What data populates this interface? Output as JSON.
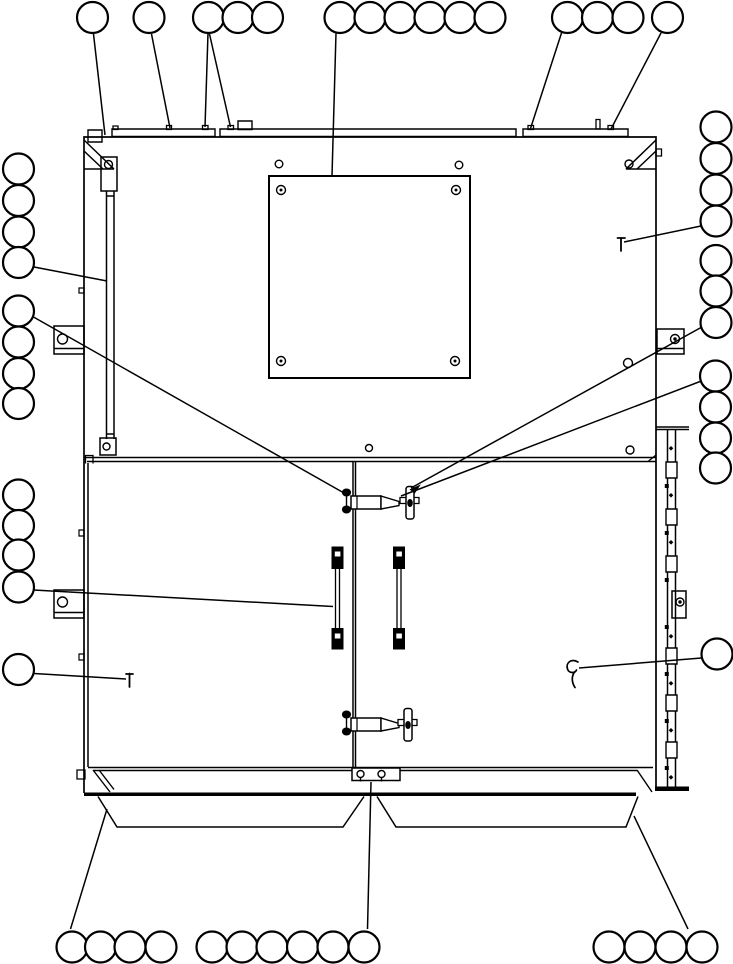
{
  "meta": {
    "width": 733,
    "height": 964,
    "background": "#ffffff",
    "line_color": "#000000",
    "balloon_radius": 15.5,
    "balloon_stroke_width": 2.2,
    "leader_stroke_width": 1.5
  },
  "balloons": [
    {
      "group": "top-row",
      "circles": [
        {
          "cx": 92.5,
          "cy": 17.5
        },
        {
          "cx": 149,
          "cy": 17.5
        },
        {
          "cx": 208.5,
          "cy": 17.5
        },
        {
          "cx": 238,
          "cy": 17.5
        },
        {
          "cx": 267.5,
          "cy": 17.5
        },
        {
          "cx": 340,
          "cy": 17.5
        },
        {
          "cx": 370,
          "cy": 17.5
        },
        {
          "cx": 400,
          "cy": 17.5
        },
        {
          "cx": 430,
          "cy": 17.5
        },
        {
          "cx": 460,
          "cy": 17.5
        },
        {
          "cx": 490,
          "cy": 17.5
        },
        {
          "cx": 567.5,
          "cy": 17.5
        },
        {
          "cx": 597.5,
          "cy": 17.5
        },
        {
          "cx": 628,
          "cy": 17.5
        },
        {
          "cx": 667.5,
          "cy": 17.5
        }
      ]
    },
    {
      "group": "left-column",
      "circles": [
        {
          "cx": 18.5,
          "cy": 169
        },
        {
          "cx": 18.5,
          "cy": 200.5
        },
        {
          "cx": 18.5,
          "cy": 232
        },
        {
          "cx": 18.5,
          "cy": 262.5
        },
        {
          "cx": 18.5,
          "cy": 311
        },
        {
          "cx": 18.5,
          "cy": 342
        },
        {
          "cx": 18.5,
          "cy": 373.5
        },
        {
          "cx": 18.5,
          "cy": 403.5
        },
        {
          "cx": 18.5,
          "cy": 495
        },
        {
          "cx": 18.5,
          "cy": 525.5
        },
        {
          "cx": 18.5,
          "cy": 555
        },
        {
          "cx": 18.5,
          "cy": 587
        },
        {
          "cx": 18.5,
          "cy": 669.5
        }
      ]
    },
    {
      "group": "right-column",
      "circles": [
        {
          "cx": 716,
          "cy": 127
        },
        {
          "cx": 716,
          "cy": 158.5
        },
        {
          "cx": 716,
          "cy": 190
        },
        {
          "cx": 716,
          "cy": 221
        },
        {
          "cx": 716,
          "cy": 260.5
        },
        {
          "cx": 716,
          "cy": 291
        },
        {
          "cx": 716,
          "cy": 322.5
        },
        {
          "cx": 715.5,
          "cy": 376
        },
        {
          "cx": 715.5,
          "cy": 407
        },
        {
          "cx": 715.5,
          "cy": 438
        },
        {
          "cx": 715.5,
          "cy": 468
        },
        {
          "cx": 717,
          "cy": 654
        }
      ]
    },
    {
      "group": "bottom-row",
      "circles": [
        {
          "cx": 72,
          "cy": 947
        },
        {
          "cx": 100.5,
          "cy": 947
        },
        {
          "cx": 130,
          "cy": 947
        },
        {
          "cx": 161,
          "cy": 947
        },
        {
          "cx": 212,
          "cy": 947
        },
        {
          "cx": 242,
          "cy": 947
        },
        {
          "cx": 272,
          "cy": 947
        },
        {
          "cx": 302.5,
          "cy": 947
        },
        {
          "cx": 333,
          "cy": 947
        },
        {
          "cx": 364,
          "cy": 947
        },
        {
          "cx": 609,
          "cy": 947
        },
        {
          "cx": 640,
          "cy": 947
        },
        {
          "cx": 671,
          "cy": 947
        },
        {
          "cx": 702,
          "cy": 947
        }
      ]
    }
  ],
  "leaders": [
    {
      "x1": 93.5,
      "y1": 34,
      "x2": 105,
      "y2": 135
    },
    {
      "x1": 151.5,
      "y1": 34,
      "x2": 170,
      "y2": 128
    },
    {
      "x1": 208,
      "y1": 33,
      "x2": 205,
      "y2": 127
    },
    {
      "x1": 209.5,
      "y1": 34,
      "x2": 230.5,
      "y2": 127
    },
    {
      "x1": 336,
      "y1": 33,
      "x2": 332,
      "y2": 176
    },
    {
      "x1": 561.5,
      "y1": 33,
      "x2": 530,
      "y2": 130
    },
    {
      "x1": 661,
      "y1": 33,
      "x2": 611,
      "y2": 129
    },
    {
      "x1": 34,
      "y1": 267,
      "x2": 107,
      "y2": 281
    },
    {
      "x1": 33.5,
      "y1": 317,
      "x2": 344,
      "y2": 493
    },
    {
      "x1": 701,
      "y1": 327.5,
      "x2": 411,
      "y2": 488
    },
    {
      "x1": 700,
      "y1": 381.5,
      "x2": 401,
      "y2": 496
    },
    {
      "x1": 701,
      "y1": 226,
      "x2": 624,
      "y2": 242
    },
    {
      "x1": 33.5,
      "y1": 590,
      "x2": 333,
      "y2": 606.5
    },
    {
      "x1": 34,
      "y1": 673.5,
      "x2": 126,
      "y2": 679
    },
    {
      "x1": 701.5,
      "y1": 658,
      "x2": 579,
      "y2": 668
    },
    {
      "x1": 70.5,
      "y1": 929,
      "x2": 107,
      "y2": 809
    },
    {
      "x1": 371,
      "y1": 782,
      "x2": 367.5,
      "y2": 929
    },
    {
      "x1": 688,
      "y1": 929,
      "x2": 634,
      "y2": 816
    }
  ],
  "symbols": [
    {
      "name": "screw-pin-right",
      "d": "M621,251 V238 M617.5,238 h7.5",
      "sw": 1.8
    },
    {
      "name": "screw-pin-left",
      "d": "M129.5,687 V673.5 M126,674 h7",
      "sw": 1.8
    },
    {
      "name": "door-stay-hook",
      "d": "M578,662 c-7,-4 -12.5,1 -10.5,7 c1.5,4.5 7.5,4.5 9,1 M574.5,672 c-3.5,5 -2.5,11 0.5,15.5",
      "sw": 1.7
    },
    {
      "name": "latch-arrowhead",
      "d": "M410.5,489.5 l9,-4 l-5,7.5 Z",
      "sw": 1,
      "fill": "#000000"
    }
  ],
  "parts": [
    {
      "name": "cabinet-frame",
      "d": "M84,793 L84,137 L656,137 L656,788",
      "sw": 1.7
    },
    {
      "name": "top-rail-left-box",
      "d": "M88,130 h14 v12 h-14 Z",
      "sw": 1.4
    },
    {
      "name": "top-rail-segments",
      "d": "M112,129 h103 v7.5 h-103 Z M220,129 h296 v7.5 h-296 Z M523,129 h105 v7.5 h-105 Z",
      "sw": 1.4
    },
    {
      "name": "top-rail-riser-box",
      "d": "M238,121 h14 v8.5 h-14 Z",
      "sw": 1.4
    },
    {
      "name": "top-rail-bolt-nubs",
      "d": "M113,126 h5 v3.5 h-5 Z M166.5,125.5 h5 v4 h-5 Z M202.5,125.5 h5.5 v4 h-5.5 Z M228,125.5 h5.5 v4 h-5.5 Z M528,125.5 h5.5 v4 h-5.5 Z M608,125.5 h5.5 v4 h-5.5 Z M596,119.5 h4 v9.5 h-4 Z",
      "sw": 1.3
    },
    {
      "name": "corner-gusset-left",
      "d": "M84,140 L114,169 M84,151 L103,169 M84,169 H114",
      "sw": 1.5
    },
    {
      "name": "corner-gusset-right",
      "d": "M656,140 L626,169 M656,151 L637,169 M626,169 H656",
      "sw": 1.5
    },
    {
      "name": "right-edge-nub",
      "d": "M656,149 h5.5 v7 h-5.5 Z",
      "sw": 1.3
    },
    {
      "name": "hinge-top-bracket",
      "d": "M101,157 h16 v34 h-16 Z",
      "sw": 1.5
    },
    {
      "name": "hinge-strip",
      "d": "M106.5,191 V439 M114,191 V439 M106.5,196 H114 M106.5,434 H114",
      "sw": 1.5
    },
    {
      "name": "hinge-bottom-bracket",
      "d": "M100,438 h16 v17 h-16 Z",
      "sw": 1.5
    },
    {
      "name": "side-bracket-left-upper",
      "d": "M54,326 h30 v28 h-30 Z M54,348.5 h30",
      "sw": 1.5
    },
    {
      "name": "side-bracket-left-lower",
      "d": "M54,590 h30 v28 h-30 Z M54,612.5 h30",
      "sw": 1.5
    },
    {
      "name": "side-bracket-right-upper",
      "d": "M657,329 h27 v25 h-27 Z M657,348.5 h27",
      "sw": 1.5
    },
    {
      "name": "side-bracket-right-lower",
      "d": "M672,591 h14 v27 h-14 Z",
      "sw": 1.5
    },
    {
      "name": "mounting-plate",
      "d": "M269,176 h201 v202 h-201 Z",
      "sw": 2
    },
    {
      "name": "panel-boundary",
      "d": "M84,457.5 H656 M87,461.5 H656",
      "sw": 1.4
    },
    {
      "name": "door-top-left-hook",
      "d": "M93,463.5 V455.5 H85.5 V463.5",
      "sw": 1.3
    },
    {
      "name": "boundary-right-notch",
      "d": "M648,461.5 L656,455",
      "sw": 1.3
    },
    {
      "name": "door-edges",
      "d": "M88,463 V767 M353,462 V767 M355.5,462 V767 M88,767.5 H653",
      "sw": 1.5
    },
    {
      "name": "door-left-tabs",
      "d": "M79,288 h5 v5 h-5 Z M79,530 h5 v6 h-5 Z M79,654 h5 v6 h-5 Z",
      "sw": 1.2
    },
    {
      "name": "hinge-rail-right",
      "d": "M656,427 h33 M656,429.5 h33 M667.5,429.5 V787 M675.5,429.5 V787",
      "sw": 1.5
    },
    {
      "name": "hinge-rail-knuckles",
      "d": "M666,462 h11 v16 h-11 Z M666,509 h11 v16 h-11 Z M666,556 h11 v16 h-11 Z M666,648 h11 v16 h-11 Z M666,695 h11 v16 h-11 Z M666,742 h11 v16 h-11 Z",
      "sw": 1.4,
      "fill": "#ffffff"
    },
    {
      "name": "hinge-rail-pins",
      "d": "M664.8,484 h4 v4 h-4 Z M664.8,531 h4 v4 h-4 Z M664.8,578 h4 v4 h-4 Z M664.8,625 h4 v4 h-4 Z M664.8,672 h4 v4 h-4 Z M664.8,719 h4 v4 h-4 Z M664.8,766 h4 v4 h-4 Z M671,446 l2.3,2.3 l-2.3,2.3 l-2.3,-2.3 Z M671,493 l2.3,2.3 l-2.3,2.3 l-2.3,-2.3 Z M671,540 l2.3,2.3 l-2.3,2.3 l-2.3,-2.3 Z M671,634 l2.3,2.3 l-2.3,2.3 l-2.3,-2.3 Z M671,681 l2.3,2.3 l-2.3,2.3 l-2.3,-2.3 Z M671,728 l2.3,2.3 l-2.3,2.3 l-2.3,-2.3 Z M671,775 l2.3,2.3 l-2.3,2.3 l-2.3,-2.3 Z",
      "sw": 0,
      "fill": "#000000"
    },
    {
      "name": "hinge-rail-bottom-cap",
      "d": "M655,786.5 h34 v4.5 h-34 Z",
      "sw": 0,
      "fill": "#000000"
    },
    {
      "name": "bottom-sill",
      "d": "M93,770.5 H637 M93,770 L110,792 M99,770 L114,789.5 M637,770 L652,792",
      "sw": 1.4
    },
    {
      "name": "bottom-left-nub",
      "d": "M77,770 h8 v9 h-8 Z",
      "sw": 1.3
    },
    {
      "name": "bottom-heavy-bar",
      "d": "M84,792.5 h552 v3.5 h-552 Z",
      "sw": 0,
      "fill": "#000000"
    },
    {
      "name": "bottom-center-hinge-plate",
      "d": "M352,768 h48 v12.5 h-48 Z",
      "sw": 1.5,
      "fill": "#ffffff"
    },
    {
      "name": "bottom-hinge-hook-tails",
      "d": "M360.5,777.5 v4 M381.5,777.5 v4",
      "sw": 1.4
    },
    {
      "name": "drip-trays",
      "d": "M98,796.5 L117,827 H343 L364,796.5 M377,796.5 L396,827 H626 L638,796.5",
      "sw": 1.5
    },
    {
      "name": "handle-left-blocks",
      "d": "M332,547 h11 v21.5 h-11 Z M332,628.5 h11 v20.5 h-11 Z",
      "sw": 1,
      "fill": "#000000"
    },
    {
      "name": "handle-left-shaft",
      "d": "M335.5,568.5 V628.5 M339.5,568.5 V628.5",
      "sw": 1.3
    },
    {
      "name": "handle-left-slits",
      "d": "M334.8,551.5 h5.6 v5 h-5.6 Z M334.8,633.5 h5.6 v5 h-5.6 Z",
      "sw": 0,
      "fill": "#ffffff"
    },
    {
      "name": "handle-right-blocks",
      "d": "M393.5,547 h11 v21.5 h-11 Z M393.5,628.5 h11 v20.5 h-11 Z",
      "sw": 1,
      "fill": "#000000"
    },
    {
      "name": "handle-right-shaft",
      "d": "M397,568.5 V628.5 M401,568.5 V628.5",
      "sw": 1.3
    },
    {
      "name": "handle-right-slits",
      "d": "M396.3,551.5 h5.6 v5 h-5.6 Z M396.3,633.5 h5.6 v5 h-5.6 Z",
      "sw": 0,
      "fill": "#ffffff"
    },
    {
      "name": "latch-upper-bolt-stem",
      "d": "M346.5,491 V511",
      "sw": 1.4
    },
    {
      "name": "latch-upper-body",
      "d": "M351,496 h30 v13 h-30 Z",
      "sw": 1.5,
      "fill": "#ffffff"
    },
    {
      "name": "latch-upper-body-line",
      "d": "M357,496 V509",
      "sw": 1.2
    },
    {
      "name": "latch-upper-cone",
      "d": "M381,496 L399,501.5 V505.5 L381,509 Z",
      "sw": 1.4,
      "fill": "#ffffff"
    },
    {
      "name": "latch-upper-pin",
      "d": "M400,497.5 h19 v6 h-19 Z",
      "sw": 1.3,
      "fill": "#ffffff"
    },
    {
      "name": "latch-lower-bolt-stem",
      "d": "M346.5,713 V733",
      "sw": 1.4
    },
    {
      "name": "latch-lower-body",
      "d": "M351,718 h30 v13 h-30 Z",
      "sw": 1.5,
      "fill": "#ffffff"
    },
    {
      "name": "latch-lower-body-line",
      "d": "M357,718 V731",
      "sw": 1.2
    },
    {
      "name": "latch-lower-cone",
      "d": "M381,718 L399,723.5 V727.5 L381,731 Z",
      "sw": 1.4,
      "fill": "#ffffff"
    },
    {
      "name": "latch-lower-pin",
      "d": "M398,719.5 h19 v6 h-19 Z",
      "sw": 1.3,
      "fill": "#ffffff"
    }
  ],
  "rects": [
    {
      "name": "latch-upper-tbar",
      "x": 406,
      "y": 486.5,
      "w": 8,
      "h": 32.5,
      "rx": 2.5
    },
    {
      "name": "latch-lower-tbar",
      "x": 404,
      "y": 708.5,
      "w": 8,
      "h": 32.5,
      "rx": 2.5
    }
  ],
  "holes": [
    {
      "name": "hinge-top-bracket-hole",
      "cx": 108.5,
      "cy": 164.5,
      "r": 4
    },
    {
      "name": "hinge-bottom-bracket-hole",
      "cx": 106.5,
      "cy": 446.5,
      "r": 3.5
    },
    {
      "name": "bracket-left-upper-hole",
      "cx": 62.5,
      "cy": 339,
      "r": 5
    },
    {
      "name": "bracket-left-lower-hole",
      "cx": 62.5,
      "cy": 602,
      "r": 5
    },
    {
      "name": "bracket-right-upper-hole",
      "cx": 675,
      "cy": 339,
      "r": 4.5
    },
    {
      "name": "bracket-right-lower-hole",
      "cx": 680,
      "cy": 602,
      "r": 4
    },
    {
      "name": "gusset-right-hole",
      "cx": 629,
      "cy": 164,
      "r": 4
    },
    {
      "name": "panel-hole-top-left",
      "cx": 279,
      "cy": 164,
      "r": 3.8
    },
    {
      "name": "panel-hole-top-right",
      "cx": 459,
      "cy": 165,
      "r": 3.8
    },
    {
      "name": "plate-bolt-tl",
      "cx": 281,
      "cy": 190,
      "r": 4.5
    },
    {
      "name": "plate-bolt-tr",
      "cx": 456,
      "cy": 190,
      "r": 4.5
    },
    {
      "name": "plate-bolt-bl",
      "cx": 281,
      "cy": 361,
      "r": 4.5
    },
    {
      "name": "plate-bolt-br",
      "cx": 455,
      "cy": 361,
      "r": 4.5
    },
    {
      "name": "panel-hole-center",
      "cx": 369,
      "cy": 448,
      "r": 3.5
    },
    {
      "name": "panel-hole-right-upper",
      "cx": 628,
      "cy": 363,
      "r": 4.5
    },
    {
      "name": "door-hole-right",
      "cx": 630,
      "cy": 450,
      "r": 4
    },
    {
      "name": "bottom-hinge-hook-left",
      "cx": 360.5,
      "cy": 774,
      "r": 3.5
    },
    {
      "name": "bottom-hinge-hook-right",
      "cx": 381.5,
      "cy": 774,
      "r": 3.5
    }
  ],
  "dots": [
    {
      "name": "latch-upper-bolt-top",
      "cx": 346.5,
      "cy": 492.5,
      "rx": 4.6,
      "ry": 4
    },
    {
      "name": "latch-upper-bolt-bottom",
      "cx": 346.5,
      "cy": 509.5,
      "rx": 4.6,
      "ry": 4
    },
    {
      "name": "latch-lower-bolt-top",
      "cx": 346.5,
      "cy": 714.5,
      "rx": 4.6,
      "ry": 4
    },
    {
      "name": "latch-lower-bolt-bottom",
      "cx": 346.5,
      "cy": 731.5,
      "rx": 4.6,
      "ry": 4
    },
    {
      "name": "latch-upper-tbar-center",
      "cx": 410,
      "cy": 503,
      "rx": 2.8,
      "ry": 4
    },
    {
      "name": "latch-lower-tbar-center",
      "cx": 408,
      "cy": 725,
      "rx": 2.8,
      "ry": 4
    },
    {
      "name": "plate-bolt-tl-center",
      "cx": 281,
      "cy": 190,
      "rx": 1.5,
      "ry": 1.5
    },
    {
      "name": "plate-bolt-tr-center",
      "cx": 456,
      "cy": 190,
      "rx": 1.5,
      "ry": 1.5
    },
    {
      "name": "plate-bolt-bl-center",
      "cx": 281,
      "cy": 361,
      "rx": 1.5,
      "ry": 1.5
    },
    {
      "name": "plate-bolt-br-center",
      "cx": 455,
      "cy": 361,
      "rx": 1.5,
      "ry": 1.5
    },
    {
      "name": "bracket-right-upper-pin",
      "cx": 675,
      "cy": 339,
      "rx": 1.7,
      "ry": 1.7
    },
    {
      "name": "bracket-right-lower-pin",
      "cx": 680,
      "cy": 602,
      "rx": 1.7,
      "ry": 1.7
    }
  ]
}
